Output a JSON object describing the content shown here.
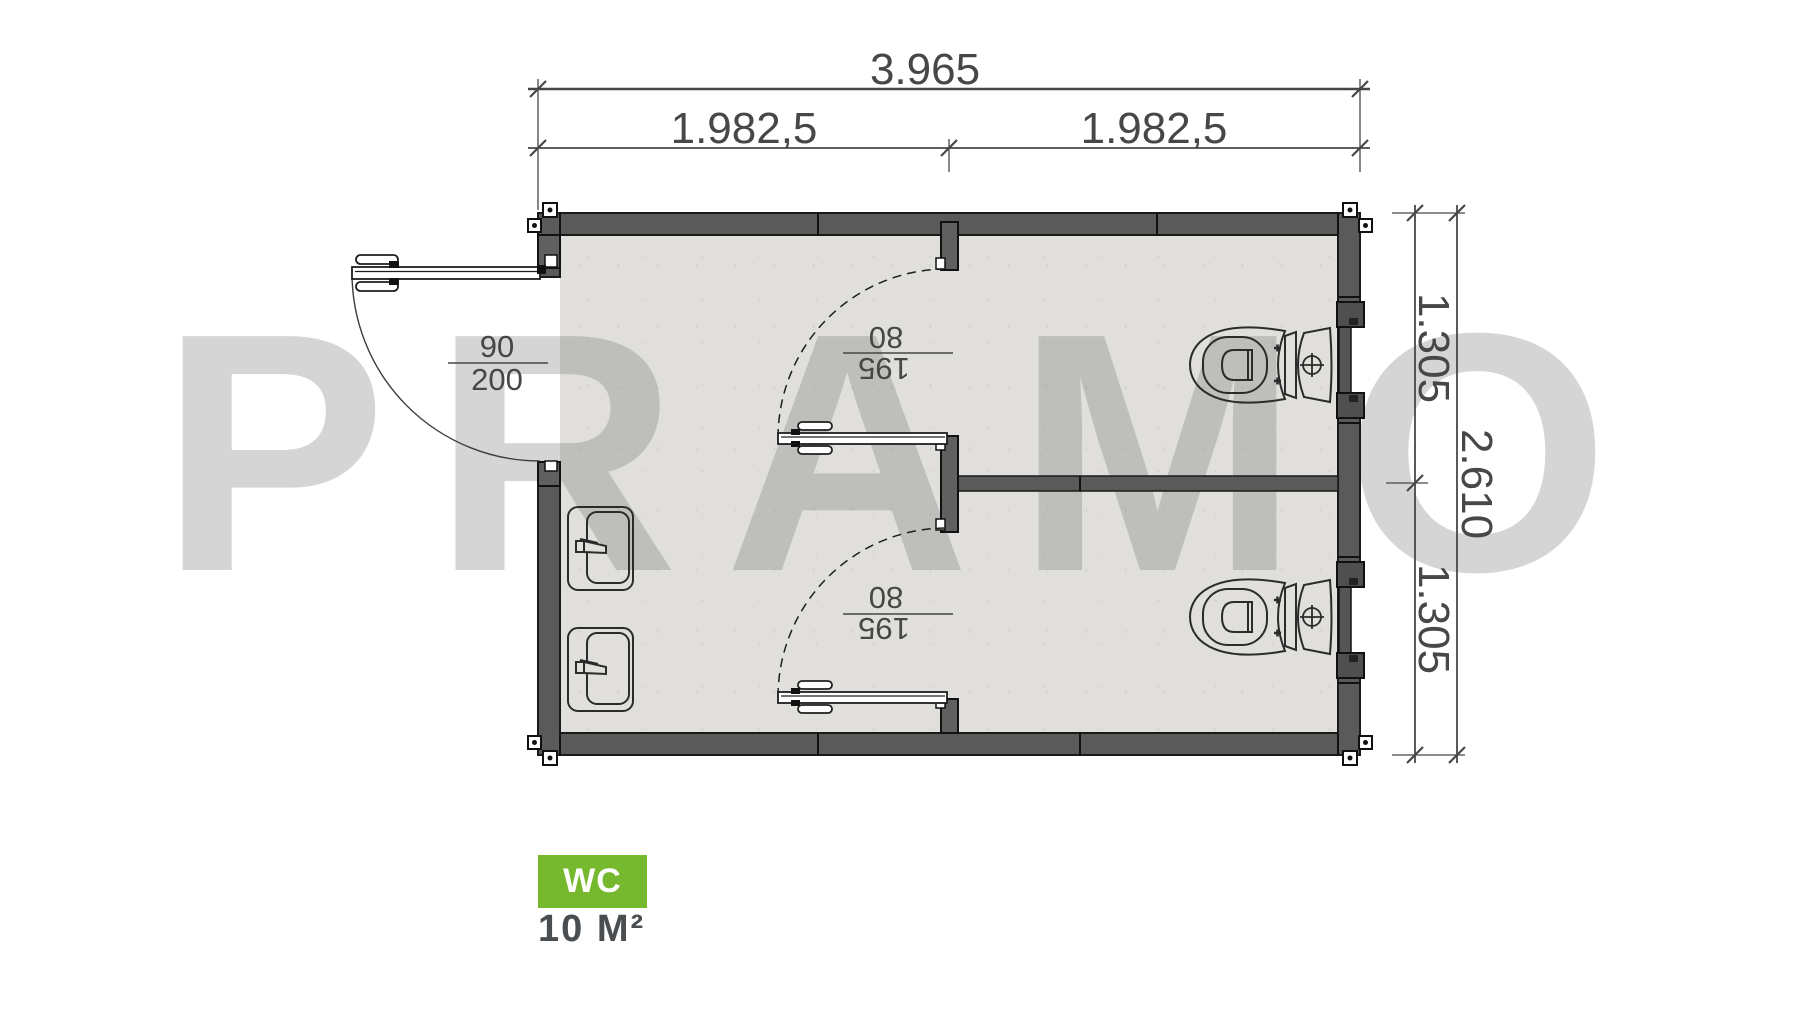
{
  "watermark": "PRAMO",
  "legend": {
    "badge": "WC",
    "area": "10 M²"
  },
  "dimensions": {
    "top": {
      "total": "3.965",
      "left_half": "1.982,5",
      "right_half": "1.982,5"
    },
    "right": {
      "upper_stall": "1.305",
      "lower_stall": "1.305",
      "total": "2.610"
    }
  },
  "doors": {
    "entry": {
      "width": "90",
      "height": "200"
    },
    "stall_upper": {
      "width": "80",
      "height": "195"
    },
    "stall_lower": {
      "width": "80",
      "height": "195"
    }
  },
  "colors": {
    "badge_green": "#76b82e",
    "area_text": "#4a4e50",
    "wall_fill": "#5a5a5a",
    "wall_outline": "#1a1a1a",
    "floor": "#e0dfdc",
    "dimension_lines": "#474747",
    "watermark_gray": "rgba(104,104,104,0.28)"
  }
}
